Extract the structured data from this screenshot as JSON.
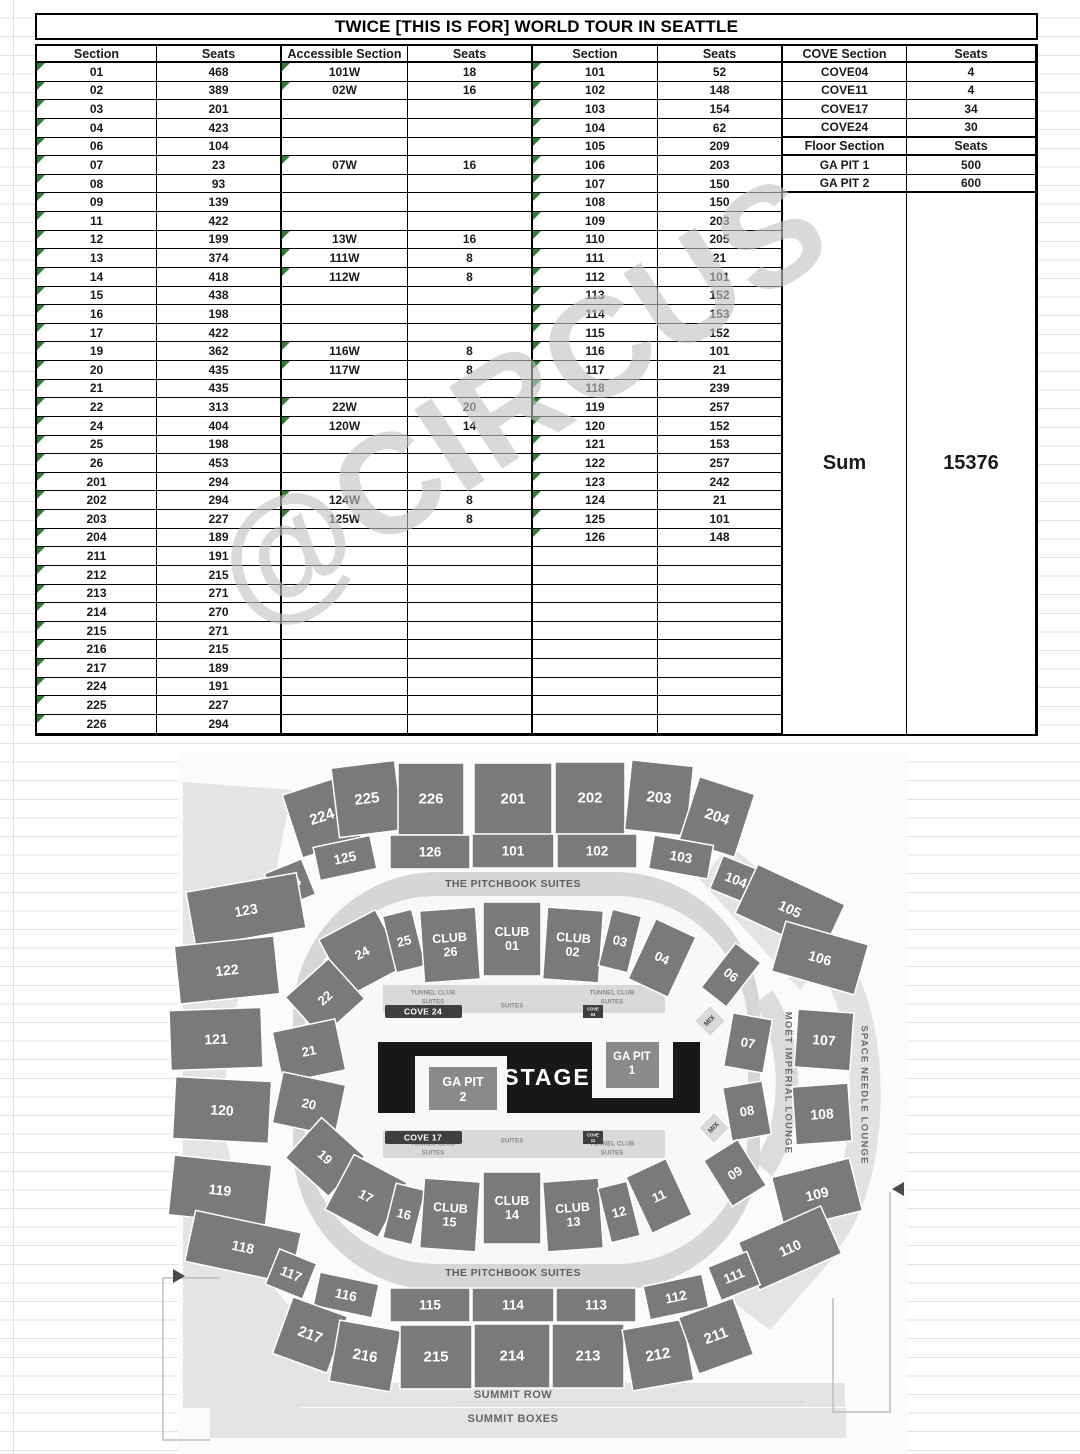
{
  "title": "TWICE [THIS IS FOR] WORLD TOUR IN SEATTLE",
  "watermark": "@CIRCUS",
  "colors": {
    "triangle_green": "#2e7d32",
    "section_gray": "#7a7a7a",
    "stage_black": "#181818",
    "pit_gray": "#8a8a8a",
    "band_light": "#d6d6d6",
    "panel_pale": "#e4e4e4",
    "cove_dark": "#3f3f3f",
    "label_gray": "#5f5f5f"
  },
  "table": {
    "headers": [
      "Section",
      "Seats",
      "Accessible Section",
      "Seats",
      "Section",
      "Seats",
      "COVE Section",
      "Seats"
    ],
    "left_rows": [
      [
        "01",
        "468",
        "101W",
        "18"
      ],
      [
        "02",
        "389",
        "02W",
        "16"
      ],
      [
        "03",
        "201",
        "",
        ""
      ],
      [
        "04",
        "423",
        "",
        ""
      ],
      [
        "06",
        "104",
        "",
        ""
      ],
      [
        "07",
        "23",
        "07W",
        "16"
      ],
      [
        "08",
        "93",
        "",
        ""
      ],
      [
        "09",
        "139",
        "",
        ""
      ],
      [
        "11",
        "422",
        "",
        ""
      ],
      [
        "12",
        "199",
        "13W",
        "16"
      ],
      [
        "13",
        "374",
        "111W",
        "8"
      ],
      [
        "14",
        "418",
        "112W",
        "8"
      ],
      [
        "15",
        "438",
        "",
        ""
      ],
      [
        "16",
        "198",
        "",
        ""
      ],
      [
        "17",
        "422",
        "",
        ""
      ],
      [
        "19",
        "362",
        "116W",
        "8"
      ],
      [
        "20",
        "435",
        "117W",
        "8"
      ],
      [
        "21",
        "435",
        "",
        ""
      ],
      [
        "22",
        "313",
        "22W",
        "20"
      ],
      [
        "24",
        "404",
        "120W",
        "14"
      ],
      [
        "25",
        "198",
        "",
        ""
      ],
      [
        "26",
        "453",
        "",
        ""
      ],
      [
        "201",
        "294",
        "",
        ""
      ],
      [
        "202",
        "294",
        "124W",
        "8"
      ],
      [
        "203",
        "227",
        "125W",
        "8"
      ],
      [
        "204",
        "189",
        "",
        ""
      ],
      [
        "211",
        "191",
        "",
        ""
      ],
      [
        "212",
        "215",
        "",
        ""
      ],
      [
        "213",
        "271",
        "",
        ""
      ],
      [
        "214",
        "270",
        "",
        ""
      ],
      [
        "215",
        "271",
        "",
        ""
      ],
      [
        "216",
        "215",
        "",
        ""
      ],
      [
        "217",
        "189",
        "",
        ""
      ],
      [
        "224",
        "191",
        "",
        ""
      ],
      [
        "225",
        "227",
        "",
        ""
      ],
      [
        "226",
        "294",
        "",
        ""
      ]
    ],
    "mid_rows": [
      [
        "101",
        "52"
      ],
      [
        "102",
        "148"
      ],
      [
        "103",
        "154"
      ],
      [
        "104",
        "62"
      ],
      [
        "105",
        "209"
      ],
      [
        "106",
        "203"
      ],
      [
        "107",
        "150"
      ],
      [
        "108",
        "150"
      ],
      [
        "109",
        "203"
      ],
      [
        "110",
        "205"
      ],
      [
        "111",
        "21"
      ],
      [
        "112",
        "101"
      ],
      [
        "113",
        "152"
      ],
      [
        "114",
        "153"
      ],
      [
        "115",
        "152"
      ],
      [
        "116",
        "101"
      ],
      [
        "117",
        "21"
      ],
      [
        "118",
        "239"
      ],
      [
        "119",
        "257"
      ],
      [
        "120",
        "152"
      ],
      [
        "121",
        "153"
      ],
      [
        "122",
        "257"
      ],
      [
        "123",
        "242"
      ],
      [
        "124",
        "21"
      ],
      [
        "125",
        "101"
      ],
      [
        "126",
        "148"
      ]
    ],
    "cove_rows": [
      [
        "COVE04",
        "4"
      ],
      [
        "COVE11",
        "4"
      ],
      [
        "COVE17",
        "34"
      ],
      [
        "COVE24",
        "30"
      ]
    ],
    "floor_header": [
      "Floor Section",
      "Seats"
    ],
    "floor_rows": [
      [
        "GA PIT 1",
        "500"
      ],
      [
        "GA PIT 2",
        "600"
      ]
    ],
    "sum_label": "Sum",
    "sum_value": "15376"
  },
  "map": {
    "outer_top": [
      "224",
      "225",
      "226",
      "201",
      "202",
      "203",
      "204"
    ],
    "ring_top": [
      "124",
      "125",
      "126",
      "101",
      "102",
      "103",
      "104"
    ],
    "outer_left": [
      "123",
      "122",
      "121",
      "120",
      "119",
      "118"
    ],
    "outer_right": [
      "105",
      "106",
      "107",
      "108",
      "109",
      "110"
    ],
    "inner_top": [
      "24",
      "25",
      "CLUB 26",
      "CLUB 01",
      "CLUB 02",
      "03",
      "04",
      "06"
    ],
    "inner_left": [
      "22",
      "21",
      "20",
      "19"
    ],
    "inner_right": [
      "07",
      "08",
      "09"
    ],
    "inner_bottom": [
      "17",
      "16",
      "CLUB 15",
      "CLUB 14",
      "CLUB 13",
      "12",
      "11"
    ],
    "ring_bottom": [
      "117",
      "116",
      "115",
      "114",
      "113",
      "112",
      "111"
    ],
    "outer_bottom": [
      "217",
      "216",
      "215",
      "214",
      "213",
      "212",
      "211"
    ],
    "bands": {
      "pitchbook": "THE PITCHBOOK SUITES",
      "summit_row": "SUMMIT ROW",
      "summit_boxes": "SUMMIT BOXES",
      "moet": "MOËT IMPÉRIAL LOUNGE",
      "space_needle": "SPACE NEEDLE LOUNGE"
    },
    "floor": {
      "stage": "STAGE",
      "ga_pit_1": "GA PIT 1",
      "ga_pit_2": "GA PIT 2"
    },
    "coves": {
      "cove24": "COVE 24",
      "cove17": "COVE 17",
      "cove04": "COVE 04",
      "cove11": "COVE 11"
    },
    "suites": {
      "tunnel": "TUNNEL CLUB SUITES",
      "suites": "SUITES"
    },
    "mix": "MIX"
  }
}
